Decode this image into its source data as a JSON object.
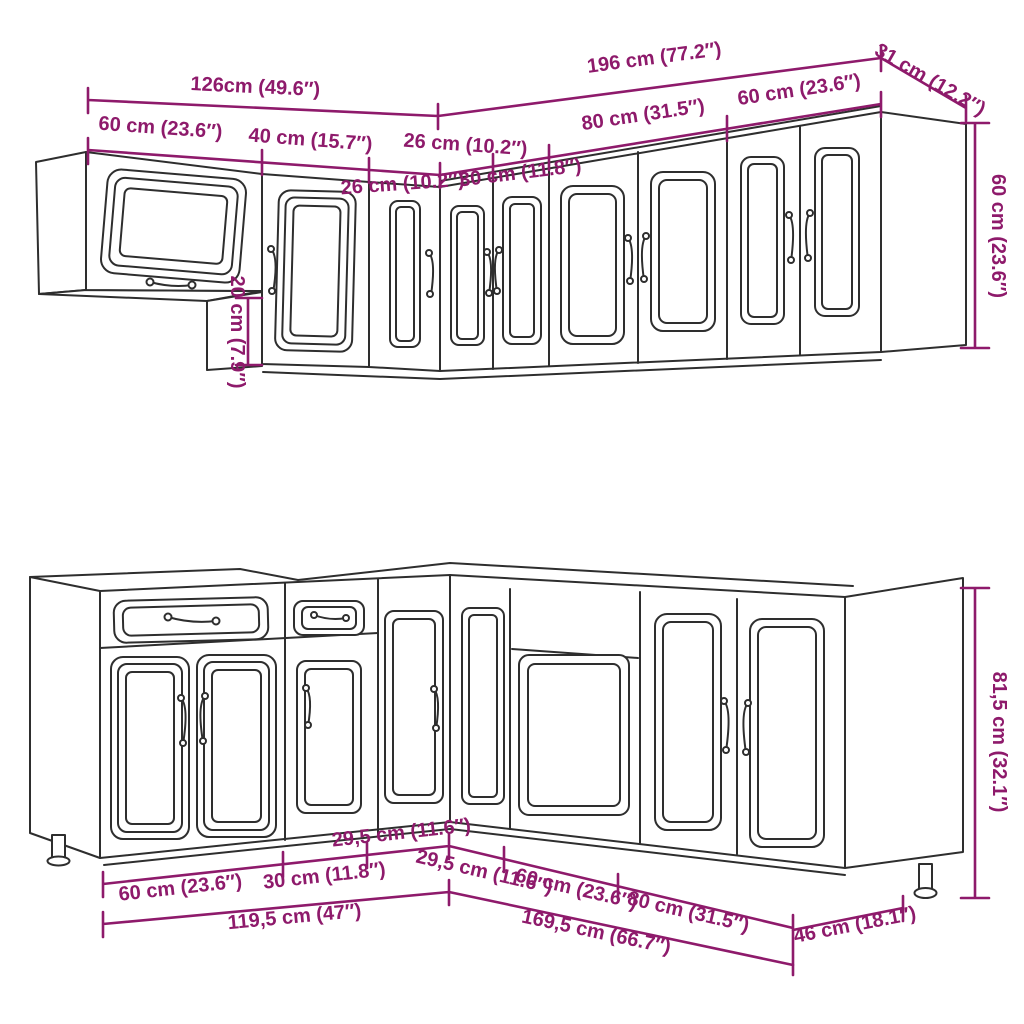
{
  "diagram": {
    "accent_color": "#8E1A6B",
    "line_color": "#2e2e2e",
    "upper_dims": {
      "total_left": "126cm (49.6″)",
      "total_right": "196 cm (77.2″)",
      "depth_right": "31 cm (12.2″)",
      "cab_60_left": "60 cm (23.6″)",
      "cab_40": "40 cm (15.7″)",
      "cab_26_a": "26 cm (10.2″)",
      "cab_26_b": "26 cm (10.2″)",
      "cab_30": "30 cm (11.8″)",
      "cab_80": "80 cm (31.5″)",
      "cab_60_right": "60 cm (23.6″)",
      "height_60": "60 cm (23.6″)",
      "offset_20": "20 cm (7.9″)"
    },
    "lower_dims": {
      "cab_29_left": "29,5 cm (11.6″)",
      "cab_29_right": "29,5 cm (11.6″)",
      "cab_60_left": "60 cm (23.6″)",
      "cab_30": "30 cm (11.8″)",
      "total_left": "119,5 cm (47″)",
      "cab_60_right": "60 cm (23.6″)",
      "cab_80": "80 cm (31.5″)",
      "total_right": "169,5 cm (66.7″)",
      "depth_46": "46 cm (18.1″)",
      "height_81": "81,5 cm (32.1″)"
    }
  }
}
